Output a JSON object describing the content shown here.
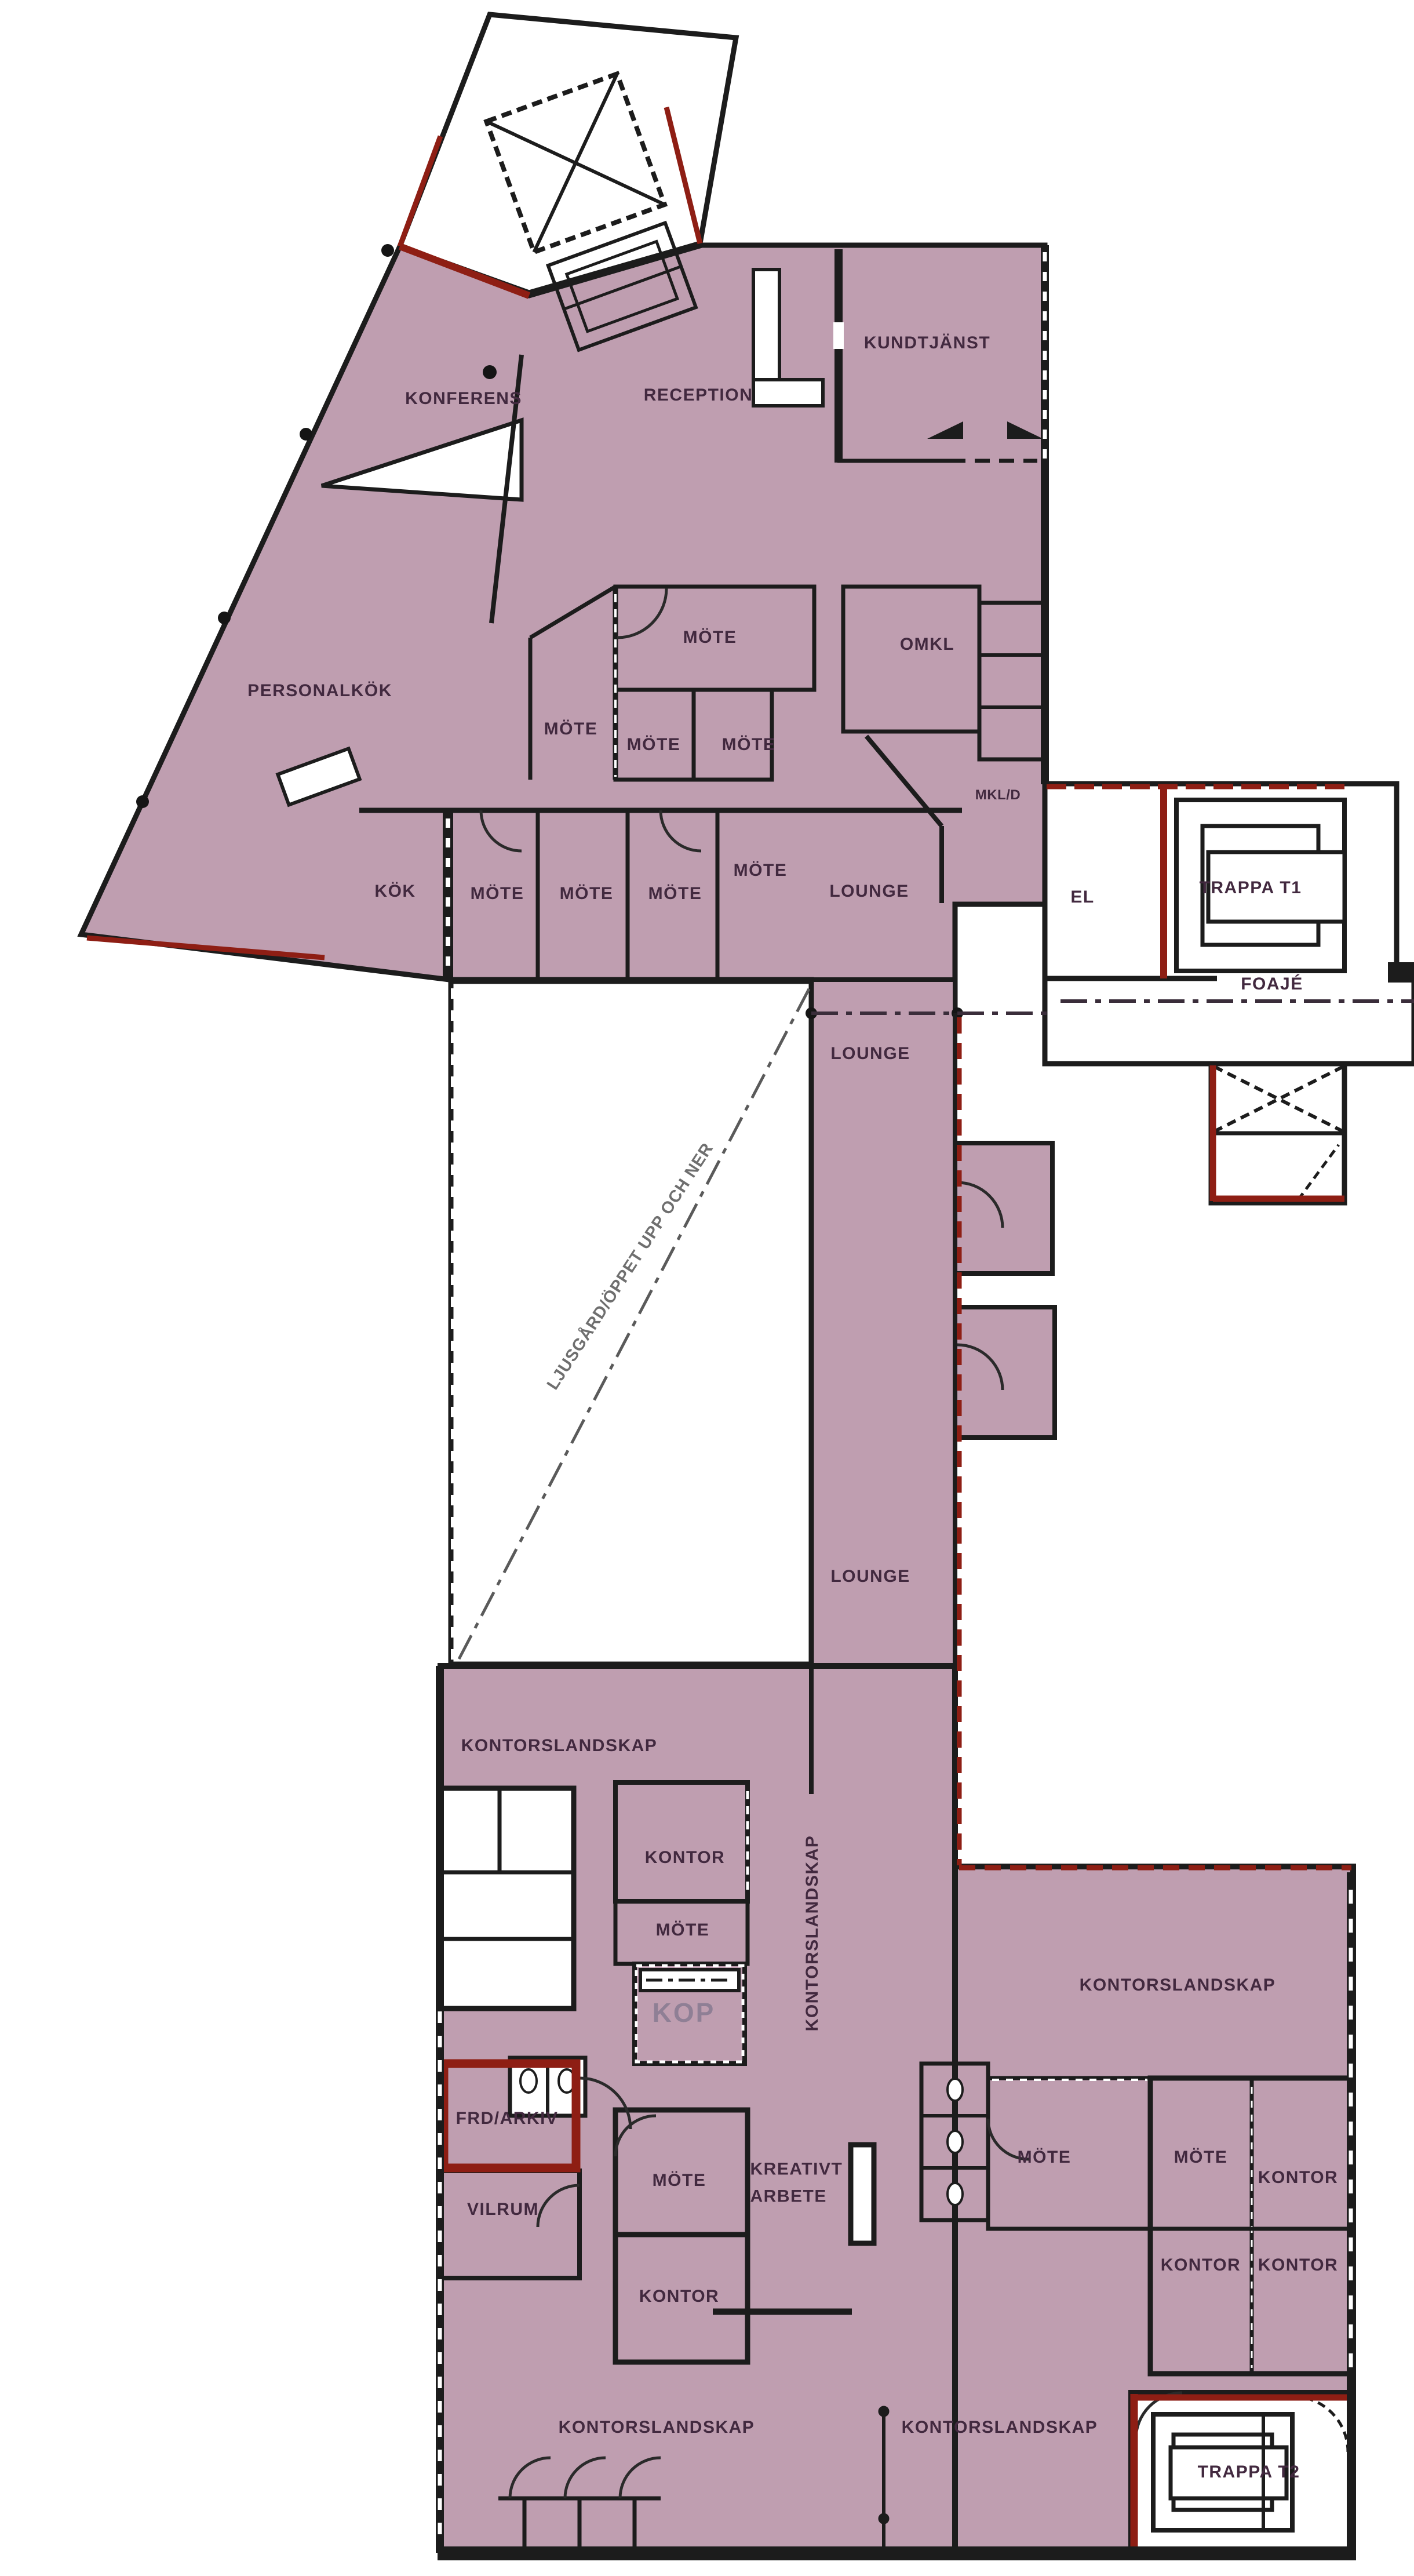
{
  "document": {
    "type": "architectural-floor-plan",
    "language": "sv",
    "description": "Office floor plan with tinted lettable area"
  },
  "colors": {
    "room_fill": "#bf9eb0",
    "wall": "#1c1c1c",
    "accent_red": "#8e1e14",
    "label_ink": "#42293f",
    "kop_ink": "#8f7f95",
    "courtyard_line": "#5a5a5a",
    "background": "#ffffff"
  },
  "rooms": [
    {
      "label": "KUNDTJÄNST"
    },
    {
      "label": "RECEPTION"
    },
    {
      "label": "KONFERENS"
    },
    {
      "label": "PERSONALKÖK"
    },
    {
      "label": "MÖTE"
    },
    {
      "label": "MÖTE"
    },
    {
      "label": "MÖTE"
    },
    {
      "label": "MÖTE"
    },
    {
      "label": "OMKL"
    },
    {
      "label": "MKL/D"
    },
    {
      "label": "KÖK"
    },
    {
      "label": "MÖTE"
    },
    {
      "label": "MÖTE"
    },
    {
      "label": "MÖTE"
    },
    {
      "label": "MÖTE"
    },
    {
      "label": "LOUNGE"
    },
    {
      "label": "EL"
    },
    {
      "label": "TRAPPA T1"
    },
    {
      "label": "FOAJÉ"
    },
    {
      "label": "LOUNGE"
    },
    {
      "label": "LOUNGE"
    },
    {
      "label": "LJUSGÅRD/ÖPPET UPP OCH NER"
    },
    {
      "label": "KONTORSLANDSKAP"
    },
    {
      "label": "KONTOR"
    },
    {
      "label": "KONTORSLANDSKAP"
    },
    {
      "label": "MÖTE"
    },
    {
      "label": "KOP"
    },
    {
      "label": "KONTORSLANDSKAP"
    },
    {
      "label": "FRD/ARKIV"
    },
    {
      "label": "VILRUM"
    },
    {
      "label": "MÖTE"
    },
    {
      "label": "KREATIVT ARBETE"
    },
    {
      "label": "KONTOR"
    },
    {
      "label": "MÖTE"
    },
    {
      "label": "MÖTE"
    },
    {
      "label": "KONTOR"
    },
    {
      "label": "KONTOR"
    },
    {
      "label": "KONTOR"
    },
    {
      "label": "KONTORSLANDSKAP"
    },
    {
      "label": "KONTORSLANDSKAP"
    },
    {
      "label": "TRAPPA T2"
    }
  ]
}
